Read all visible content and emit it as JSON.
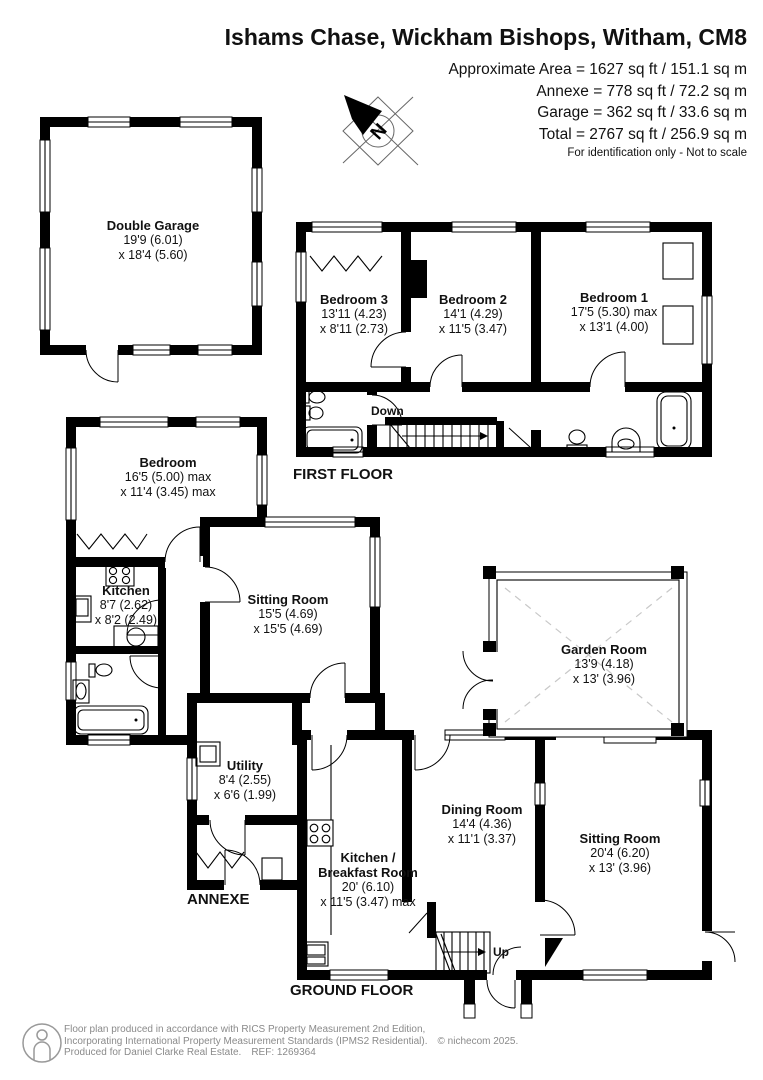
{
  "header": {
    "title": "Ishams Chase, Wickham Bishops, Witham, CM8",
    "area_lines": [
      "Approximate Area = 1627 sq ft / 151.1 sq m",
      "Annexe = 778 sq ft / 72.2 sq m",
      "Garage = 362 sq ft / 33.6 sq m",
      "Total = 2767 sq ft / 256.9 sq m"
    ],
    "disclaimer": "For identification only - Not to scale",
    "compass_letter": "N"
  },
  "labels": {
    "first_floor": "FIRST FLOOR",
    "ground_floor": "GROUND FLOOR",
    "annexe": "ANNEXE",
    "stairs_down": "Down",
    "stairs_up": "Up"
  },
  "rooms": {
    "double_garage": {
      "name": "Double Garage",
      "dim1": "19'9 (6.01)",
      "dim2": "x 18'4 (5.60)"
    },
    "bedroom3": {
      "name": "Bedroom 3",
      "dim1": "13'11 (4.23)",
      "dim2": "x 8'11 (2.73)"
    },
    "bedroom2": {
      "name": "Bedroom 2",
      "dim1": "14'1 (4.29)",
      "dim2": "x 11'5 (3.47)"
    },
    "bedroom1": {
      "name": "Bedroom 1",
      "dim1": "17'5 (5.30) max",
      "dim2": "x 13'1 (4.00)"
    },
    "annexe_bedroom": {
      "name": "Bedroom",
      "dim1": "16'5 (5.00) max",
      "dim2": "x 11'4 (3.45) max"
    },
    "annexe_kitchen": {
      "name": "Kitchen",
      "dim1": "8'7 (2.62)",
      "dim2": "x 8'2 (2.49)"
    },
    "annexe_sitting_room": {
      "name": "Sitting Room",
      "dim1": "15'5 (4.69)",
      "dim2": "x 15'5 (4.69)"
    },
    "garden_room": {
      "name": "Garden Room",
      "dim1": "13'9 (4.18)",
      "dim2": "x 13' (3.96)"
    },
    "utility": {
      "name": "Utility",
      "dim1": "8'4 (2.55)",
      "dim2": "x 6'6 (1.99)"
    },
    "dining_room": {
      "name": "Dining Room",
      "dim1": "14'4 (4.36)",
      "dim2": "x 11'1 (3.37)"
    },
    "kitchen_breakfast_room": {
      "name": "Kitchen /\nBreakfast Room",
      "dim1": "20' (6.10)",
      "dim2": "x 11'5 (3.47) max"
    },
    "sitting_room": {
      "name": "Sitting Room",
      "dim1": "20'4 (6.20)",
      "dim2": "x 13' (3.96)"
    }
  },
  "footer": {
    "line1": "Floor plan produced in accordance with RICS Property Measurement 2nd Edition,",
    "line2": "Incorporating International Property Measurement Standards (IPMS2 Residential).",
    "copyright": "© nichecom 2025.",
    "line3": "Produced for Daniel Clarke Real Estate.",
    "ref": "REF: 1269364"
  },
  "colors": {
    "walls": "#000000",
    "background": "#ffffff",
    "footer_text": "#8a8a8a",
    "garden_room_dash": "#c8c8c8"
  }
}
